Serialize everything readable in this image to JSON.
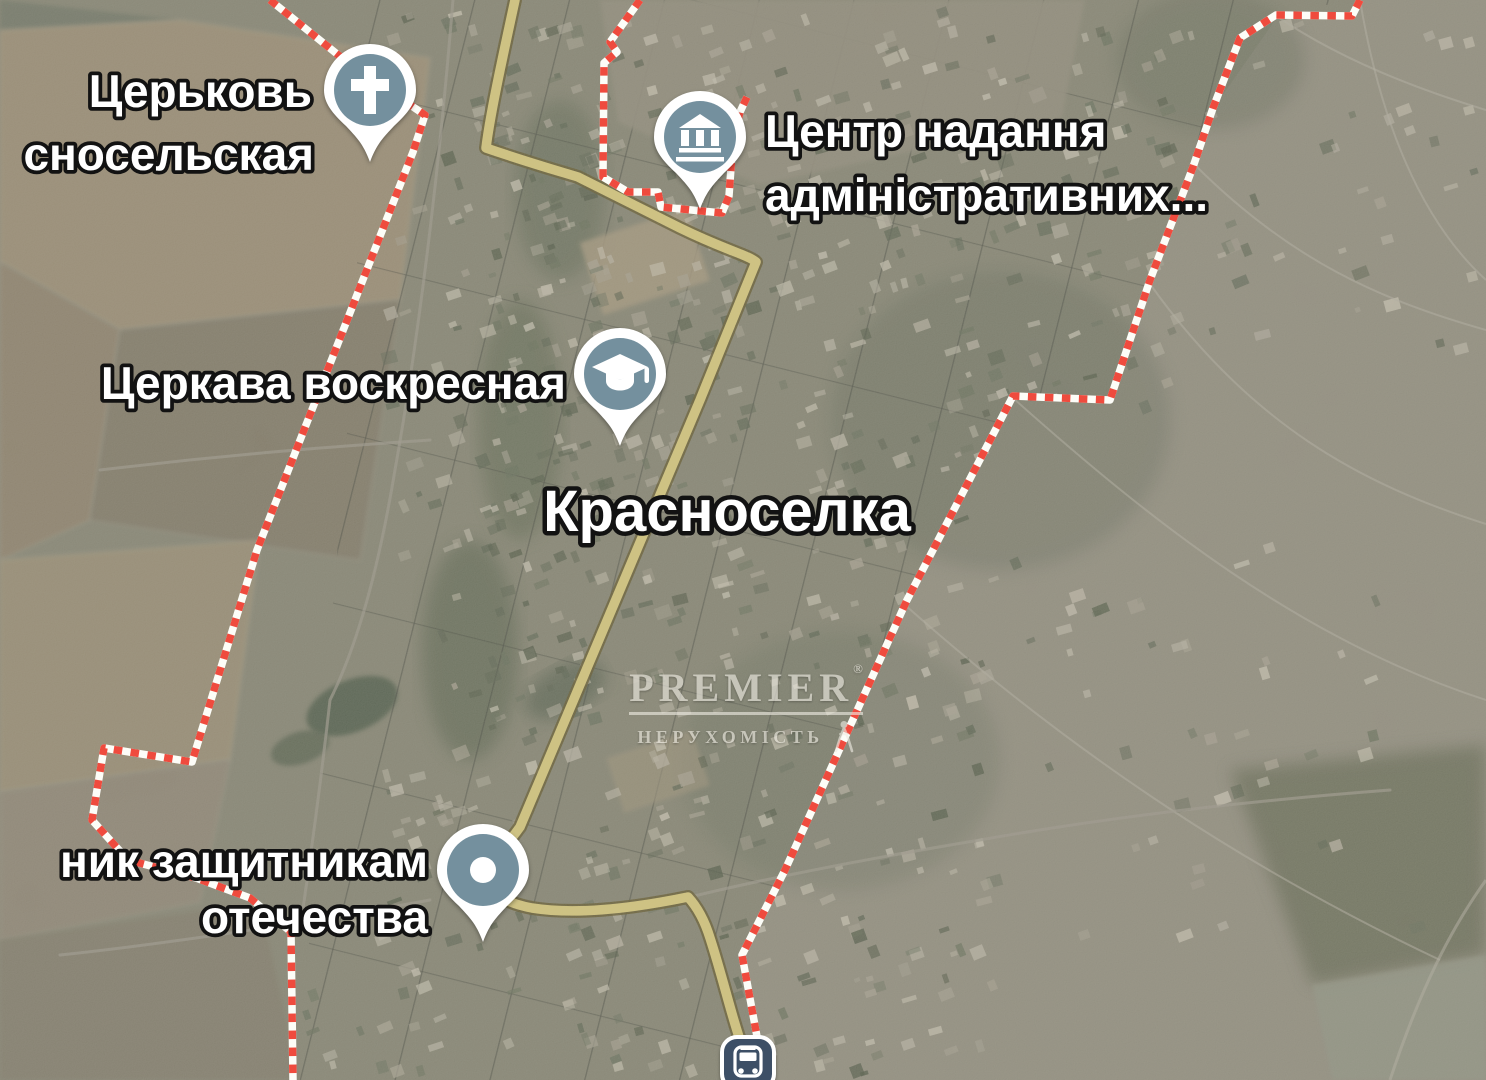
{
  "map": {
    "town_label": "Красноселка",
    "labels": {
      "church_krasnoselskaya": {
        "line1": "Церьковь",
        "line2": "сносельская"
      },
      "admin_center": {
        "line1": "Центр надання",
        "line2": "адміністративних..."
      },
      "church_voskresnaya": {
        "text": "Церкава воскресная"
      },
      "monument": {
        "line1": "ник защитникам",
        "line2": "отечества"
      }
    },
    "pins": {
      "church_krasnoselskaya": {
        "icon": "cross-icon"
      },
      "admin_center": {
        "icon": "government-building-icon"
      },
      "church_voskresnaya": {
        "icon": "graduation-cap-icon"
      },
      "monument": {
        "icon": "dot-icon"
      },
      "bus_stop": {
        "icon": "bus-icon"
      }
    },
    "watermark": {
      "brand": "PREMIER",
      "reg": "®",
      "sub": "НЕРУХОМІСТЬ"
    },
    "colors": {
      "boundary_red": "#ef4b3e",
      "boundary_white": "#fdfdf8",
      "road_yellow": "#d9c878",
      "road_casing": "#5f5327",
      "pin_circle": "#74909e",
      "bus_background": "#3d4f66",
      "label_fill": "#ffffff",
      "label_outline": "#121212"
    }
  }
}
